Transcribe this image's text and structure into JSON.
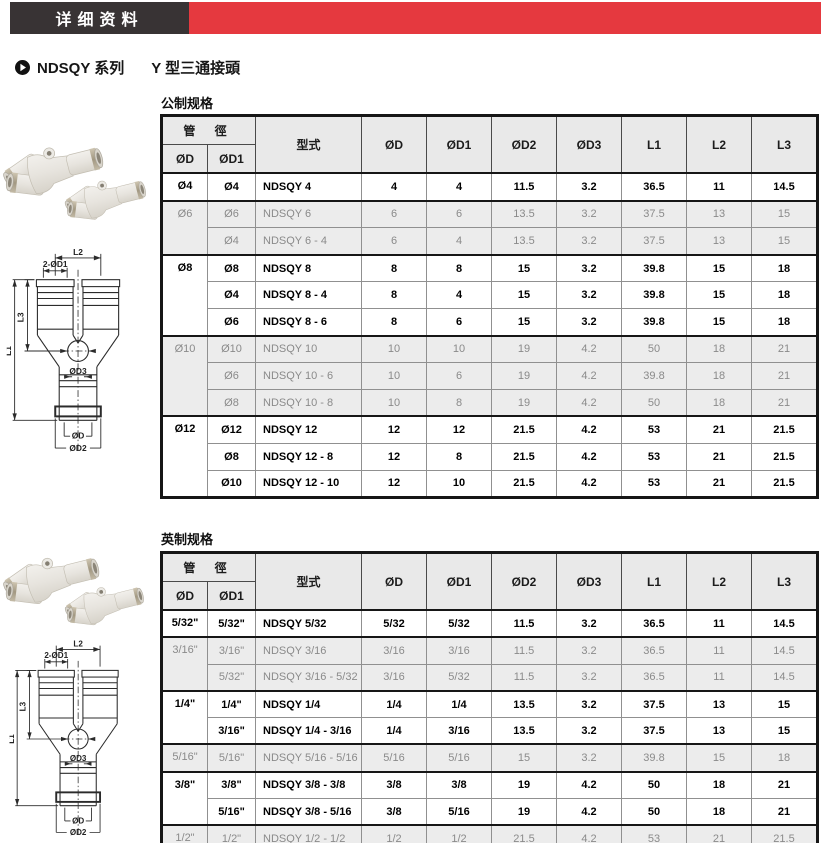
{
  "topbar": {
    "tab_label": "详细资料"
  },
  "title": {
    "series": "NDSQY 系列",
    "type": "Y 型三通接頭"
  },
  "diagram": {
    "l2": "L2",
    "two_d1": "2-ØD1",
    "l3": "L3",
    "l1": "L1",
    "d3": "ØD3",
    "d": "ØD",
    "d2": "ØD2"
  },
  "colors": {
    "accent_red": "#e5393f",
    "bar_dark": "#383334",
    "header_bg": "#e9e9e9",
    "muted_row_bg": "#ececec",
    "muted_text": "#8a8a8a"
  },
  "sections": [
    {
      "label": "公制规格",
      "table": {
        "pipe_header": "管 徑",
        "col_headers": [
          "ØD",
          "ØD1",
          "型式",
          "ØD",
          "ØD1",
          "ØD2",
          "ØD3",
          "L1",
          "L2",
          "L3"
        ],
        "groups": [
          {
            "od": "Ø4",
            "emphasis": true,
            "rows": [
              [
                "Ø4",
                "NDSQY 4",
                "4",
                "4",
                "11.5",
                "3.2",
                "36.5",
                "11",
                "14.5"
              ]
            ]
          },
          {
            "od": "Ø6",
            "emphasis": false,
            "rows": [
              [
                "Ø6",
                "NDSQY 6",
                "6",
                "6",
                "13.5",
                "3.2",
                "37.5",
                "13",
                "15"
              ],
              [
                "Ø4",
                "NDSQY 6 - 4",
                "6",
                "4",
                "13.5",
                "3.2",
                "37.5",
                "13",
                "15"
              ]
            ]
          },
          {
            "od": "Ø8",
            "emphasis": true,
            "rows": [
              [
                "Ø8",
                "NDSQY 8",
                "8",
                "8",
                "15",
                "3.2",
                "39.8",
                "15",
                "18"
              ],
              [
                "Ø4",
                "NDSQY 8 - 4",
                "8",
                "4",
                "15",
                "3.2",
                "39.8",
                "15",
                "18"
              ],
              [
                "Ø6",
                "NDSQY 8 - 6",
                "8",
                "6",
                "15",
                "3.2",
                "39.8",
                "15",
                "18"
              ]
            ]
          },
          {
            "od": "Ø10",
            "emphasis": false,
            "rows": [
              [
                "Ø10",
                "NDSQY 10",
                "10",
                "10",
                "19",
                "4.2",
                "50",
                "18",
                "21"
              ],
              [
                "Ø6",
                "NDSQY 10 - 6",
                "10",
                "6",
                "19",
                "4.2",
                "39.8",
                "18",
                "21"
              ],
              [
                "Ø8",
                "NDSQY 10 - 8",
                "10",
                "8",
                "19",
                "4.2",
                "50",
                "18",
                "21"
              ]
            ]
          },
          {
            "od": "Ø12",
            "emphasis": true,
            "rows": [
              [
                "Ø12",
                "NDSQY 12",
                "12",
                "12",
                "21.5",
                "4.2",
                "53",
                "21",
                "21.5"
              ],
              [
                "Ø8",
                "NDSQY 12 - 8",
                "12",
                "8",
                "21.5",
                "4.2",
                "53",
                "21",
                "21.5"
              ],
              [
                "Ø10",
                "NDSQY 12 - 10",
                "12",
                "10",
                "21.5",
                "4.2",
                "53",
                "21",
                "21.5"
              ]
            ]
          }
        ]
      }
    },
    {
      "label": "英制规格",
      "table": {
        "pipe_header": "管 徑",
        "col_headers": [
          "ØD",
          "ØD1",
          "型式",
          "ØD",
          "ØD1",
          "ØD2",
          "ØD3",
          "L1",
          "L2",
          "L3"
        ],
        "groups": [
          {
            "od": "5/32\"",
            "emphasis": true,
            "rows": [
              [
                "5/32\"",
                "NDSQY 5/32",
                "5/32",
                "5/32",
                "11.5",
                "3.2",
                "36.5",
                "11",
                "14.5"
              ]
            ]
          },
          {
            "od": "3/16\"",
            "emphasis": false,
            "rows": [
              [
                "3/16\"",
                "NDSQY 3/16",
                "3/16",
                "3/16",
                "11.5",
                "3.2",
                "36.5",
                "11",
                "14.5"
              ],
              [
                "5/32\"",
                "NDSQY 3/16 - 5/32",
                "3/16",
                "5/32",
                "11.5",
                "3.2",
                "36.5",
                "11",
                "14.5"
              ]
            ]
          },
          {
            "od": "1/4\"",
            "emphasis": true,
            "rows": [
              [
                "1/4\"",
                "NDSQY 1/4",
                "1/4",
                "1/4",
                "13.5",
                "3.2",
                "37.5",
                "13",
                "15"
              ],
              [
                "3/16\"",
                "NDSQY 1/4 - 3/16",
                "1/4",
                "3/16",
                "13.5",
                "3.2",
                "37.5",
                "13",
                "15"
              ]
            ]
          },
          {
            "od": "5/16\"",
            "emphasis": false,
            "rows": [
              [
                "5/16\"",
                "NDSQY 5/16 - 5/16",
                "5/16",
                "5/16",
                "15",
                "3.2",
                "39.8",
                "15",
                "18"
              ]
            ]
          },
          {
            "od": "3/8\"",
            "emphasis": true,
            "rows": [
              [
                "3/8\"",
                "NDSQY 3/8 - 3/8",
                "3/8",
                "3/8",
                "19",
                "4.2",
                "50",
                "18",
                "21"
              ],
              [
                "5/16\"",
                "NDSQY 3/8 - 5/16",
                "3/8",
                "5/16",
                "19",
                "4.2",
                "50",
                "18",
                "21"
              ]
            ]
          },
          {
            "od": "1/2\"",
            "emphasis": false,
            "rows": [
              [
                "1/2\"",
                "NDSQY 1/2 - 1/2",
                "1/2",
                "1/2",
                "21.5",
                "4.2",
                "53",
                "21",
                "21.5"
              ],
              [
                "3/8\"",
                "NDSQY 1/2 - 3/8",
                "1/2",
                "3/8",
                "21.5",
                "4.2",
                "53",
                "21",
                "21.5"
              ]
            ]
          }
        ]
      }
    }
  ]
}
